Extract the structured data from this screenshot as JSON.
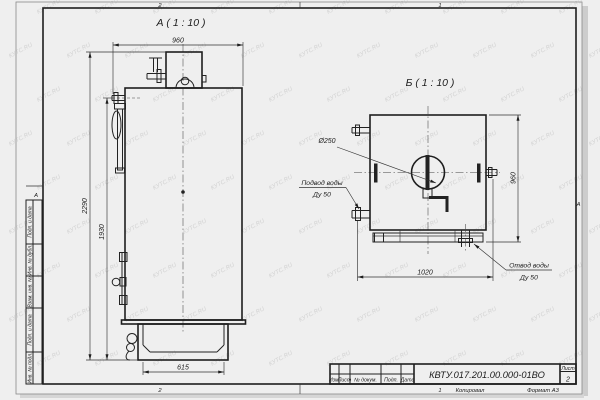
{
  "watermark": {
    "text": "КУТС.RU"
  },
  "sheet": {
    "zone_col_left": "2",
    "zone_col_right": "1",
    "zone_row": "А"
  },
  "views": {
    "front": {
      "title": "А ( 1 : 10 )",
      "dim_width": "960",
      "dim_height_overall": "2290",
      "dim_height_body": "1930",
      "dim_base_width": "615"
    },
    "side": {
      "title": "Б ( 1 : 10 )",
      "dim_height": "960",
      "dim_width": "1020",
      "dim_flue": "Ø250",
      "label_inlet_1": "Подвод воды",
      "label_inlet_2": "Ду 50",
      "label_outlet_1": "Отвод воды",
      "label_outlet_2": "Ду 50"
    }
  },
  "margin_labels": [
    "Подп. и дата",
    "Инв. № дубл.",
    "Взам. инв. №",
    "Подп. и дата",
    "Инв. № подл."
  ],
  "title_block": {
    "designation": "КВТУ.017.201.00.000-01ВО",
    "col_izm": "Изм.",
    "col_list": "Лист",
    "col_ndoc": "№ докум.",
    "col_podp": "Подп.",
    "col_data": "Дата",
    "sheet_label": "Лист",
    "sheet_number": "2",
    "footer_copy": "Копировал",
    "footer_format": "Формат А3"
  }
}
